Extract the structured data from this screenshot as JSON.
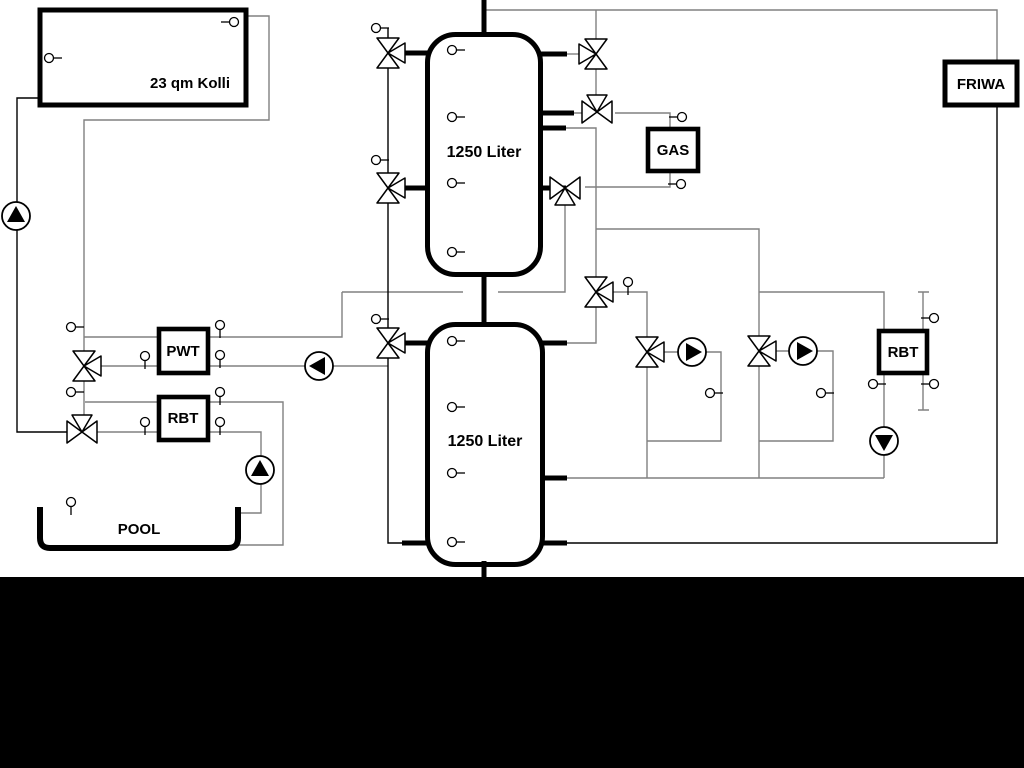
{
  "labels": {
    "collector": "23 qm Kolli",
    "tank_top": "1250 Liter",
    "tank_bottom": "1250 Liter",
    "pwt": "PWT",
    "rbt_left": "RBT",
    "gas": "GAS",
    "friwa": "FRIWA",
    "rbt_right": "RBT",
    "pool": "POOL"
  },
  "colors": {
    "pipe_gray": "#808080",
    "pipe_black": "#000000",
    "component_border": "#000000",
    "background": "#ffffff",
    "footer_bar": "#000000"
  }
}
